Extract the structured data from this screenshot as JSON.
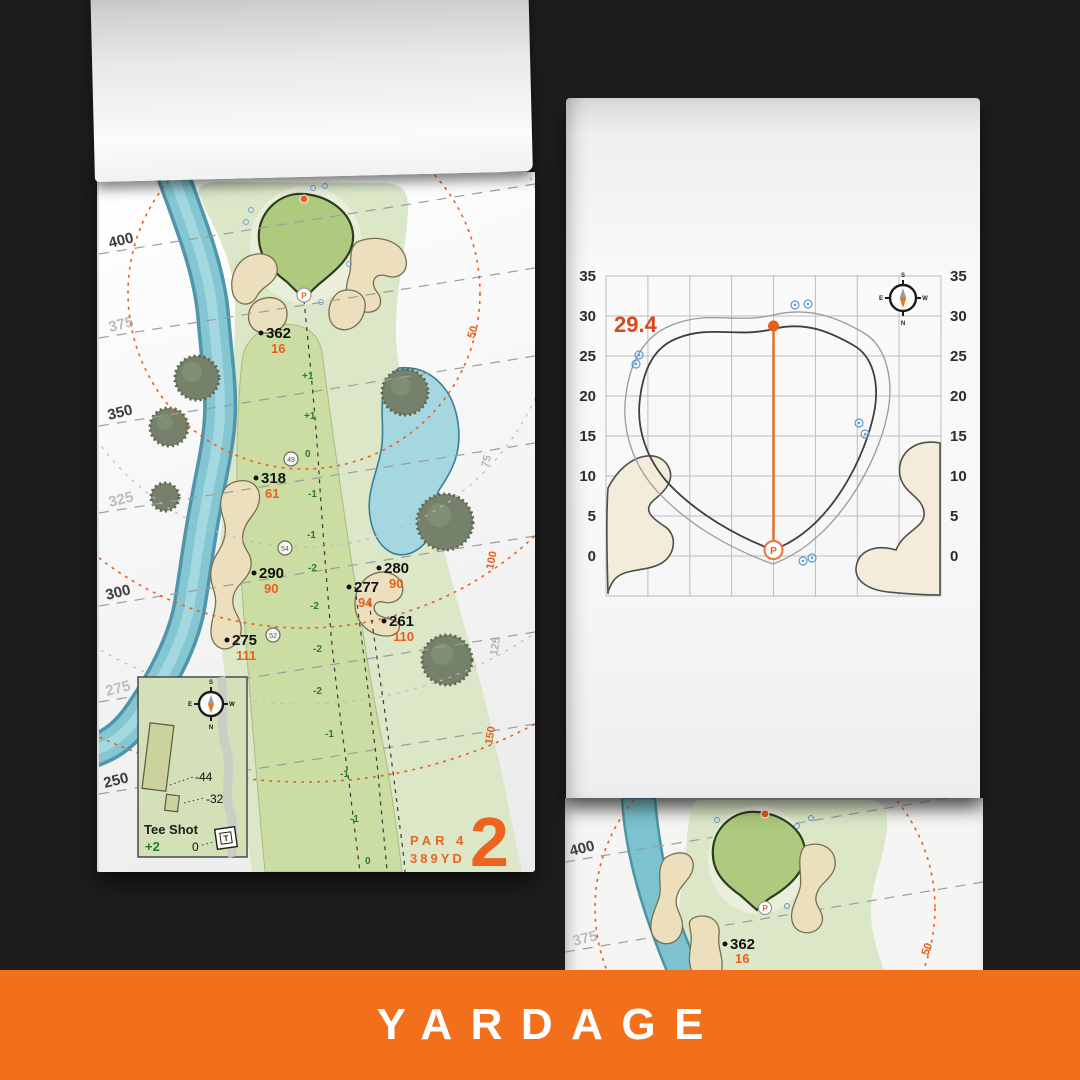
{
  "banner": {
    "label": "YARDAGE"
  },
  "colors": {
    "accent_orange": "#f2701c",
    "text_orange": "#e8601c",
    "front_number_orange": "#d9481b",
    "elevation_green": "#2c7a35",
    "water_blue": "#7cc3cf",
    "sprinkler_blue": "#5b9bd5",
    "bunker_sand": "#ecdfbe"
  },
  "hole_page": {
    "hole_number": "2",
    "par_label": "PAR 4",
    "yardage_label": "389YD",
    "pin_label": "P",
    "yard_lines": [
      {
        "label": "400",
        "emphasis": true
      },
      {
        "label": "375",
        "emphasis": false
      },
      {
        "label": "350",
        "emphasis": true
      },
      {
        "label": "325",
        "emphasis": false
      },
      {
        "label": "300",
        "emphasis": true
      },
      {
        "label": "275",
        "emphasis": false
      },
      {
        "label": "250",
        "emphasis": true
      }
    ],
    "arc_labels": [
      {
        "label": "50",
        "color": "orange"
      },
      {
        "label": "75",
        "color": "gray"
      },
      {
        "label": "100",
        "color": "orange"
      },
      {
        "label": "125",
        "color": "gray"
      },
      {
        "label": "150",
        "color": "orange"
      }
    ],
    "targets": [
      {
        "carry": "362",
        "to_pin": "16"
      },
      {
        "carry": "318",
        "to_pin": "61"
      },
      {
        "carry": "290",
        "to_pin": "90"
      },
      {
        "carry": "280",
        "to_pin": "90"
      },
      {
        "carry": "277",
        "to_pin": "94"
      },
      {
        "carry": "261",
        "to_pin": "110"
      },
      {
        "carry": "275",
        "to_pin": "111"
      }
    ],
    "elevation_markers": [
      "+1",
      "+1",
      "0",
      "-1",
      "-1",
      "-2",
      "-2",
      "-2",
      "-2",
      "-1",
      "-1",
      "-1",
      "0"
    ],
    "waypoints": [
      "49",
      "54",
      "52"
    ],
    "tee_inset": {
      "title": "Tee Shot",
      "elevation": "+2",
      "tee_distance": "0",
      "tee_icon": "T",
      "offsets": [
        "-44",
        "-32"
      ],
      "compass": {
        "top": "S",
        "right": "W",
        "bottom": "N",
        "left": "E"
      }
    }
  },
  "green_page": {
    "front_number": "29.4",
    "pin_label": "P",
    "axis_ticks": [
      "35",
      "30",
      "25",
      "20",
      "15",
      "10",
      "5",
      "0"
    ],
    "compass": {
      "top": "S",
      "right": "W",
      "bottom": "N",
      "left": "E"
    }
  },
  "next_page": {
    "yard_lines": [
      "400",
      "375"
    ],
    "target": {
      "carry": "362",
      "to_pin": "16"
    },
    "arc_label": "50",
    "pin_label": "P"
  }
}
